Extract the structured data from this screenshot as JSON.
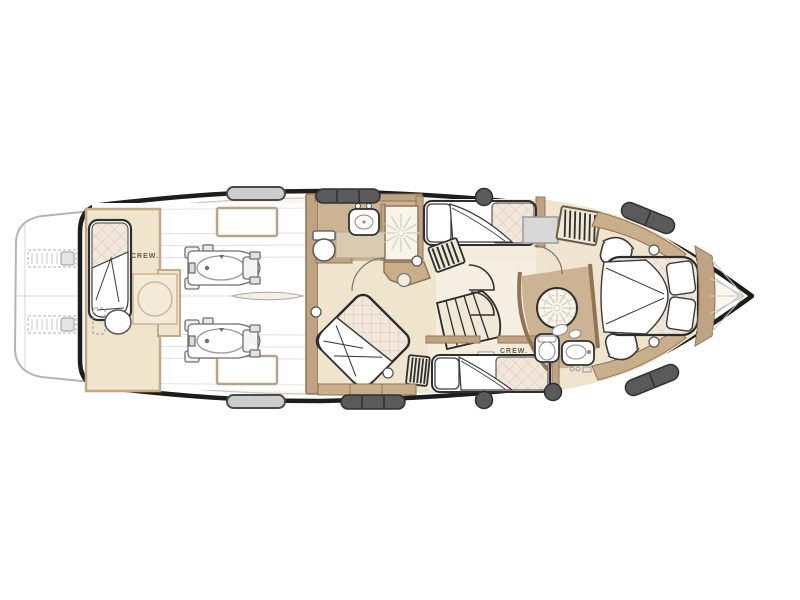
{
  "plan": {
    "labels": {
      "aft_crew_cabin": "CREW.",
      "starboard_crew_cabin": "CREW."
    },
    "colors": {
      "background": "#ffffff",
      "hull_outline": "#1d1d1b",
      "inner_deck_line": "#c9c9c9",
      "floor_beige": "#efe5ce",
      "bathroom_floor_tan": "#cbb394",
      "corridor_light": "#f5efe1",
      "wall_tan": "#c0a383",
      "wall_outline": "#8f7456",
      "mattress_quilt": "#f2e7db",
      "quilt_grid_line": "#dbc7b8",
      "hatch_dark_gray": "#5a5a5a",
      "hatch_light_gray": "#cccccc",
      "swim_platform_gray": "#b5b5b5",
      "engine_line_gray": "#6f6f6f"
    }
  }
}
